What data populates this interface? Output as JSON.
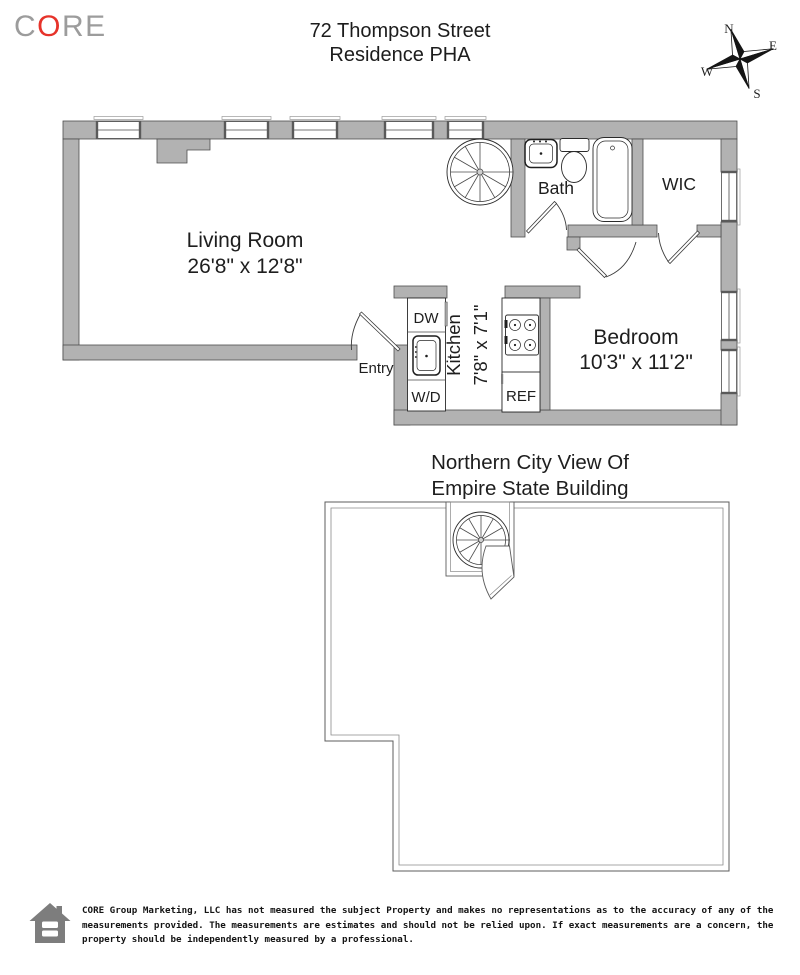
{
  "header": {
    "logo_c": "C",
    "logo_o": "O",
    "logo_re": "RE",
    "title_line1": "72 Thompson Street",
    "title_line2": "Residence PHA"
  },
  "compass": {
    "north": "N",
    "east": "E",
    "south": "S",
    "west": "W"
  },
  "main_floor": {
    "living_room_name": "Living Room",
    "living_room_dims": "26'8\" x 12'8\"",
    "bath_name": "Bath",
    "wic_name": "WIC",
    "bedroom_name": "Bedroom",
    "bedroom_dims": "10'3\" x 11'2\"",
    "kitchen_name": "Kitchen",
    "kitchen_dims": "7'8\" x 7'1\"",
    "dw_label": "DW",
    "wd_label": "W/D",
    "ref_label": "REF",
    "entry_label": "Entry"
  },
  "roof": {
    "caption_line1": "Northern City View Of",
    "caption_line2": "Empire State Building"
  },
  "footer": {
    "line1": "CORE Group Marketing, LLC has not measured the subject Property and makes no representations as to the accuracy of any of the",
    "line2": "measurements provided. The measurements are estimates and should not be relied upon. If exact measurements are a concern, the",
    "line3": "property should be independently measured by a professional."
  },
  "colors": {
    "wall": "#b2b2b2",
    "wall_outline": "#4d4d4d",
    "logo_gray": "#9c9c9c",
    "logo_red": "#e6332a",
    "ink": "#1e1e1e",
    "icon_gray": "#7d7d7d"
  }
}
